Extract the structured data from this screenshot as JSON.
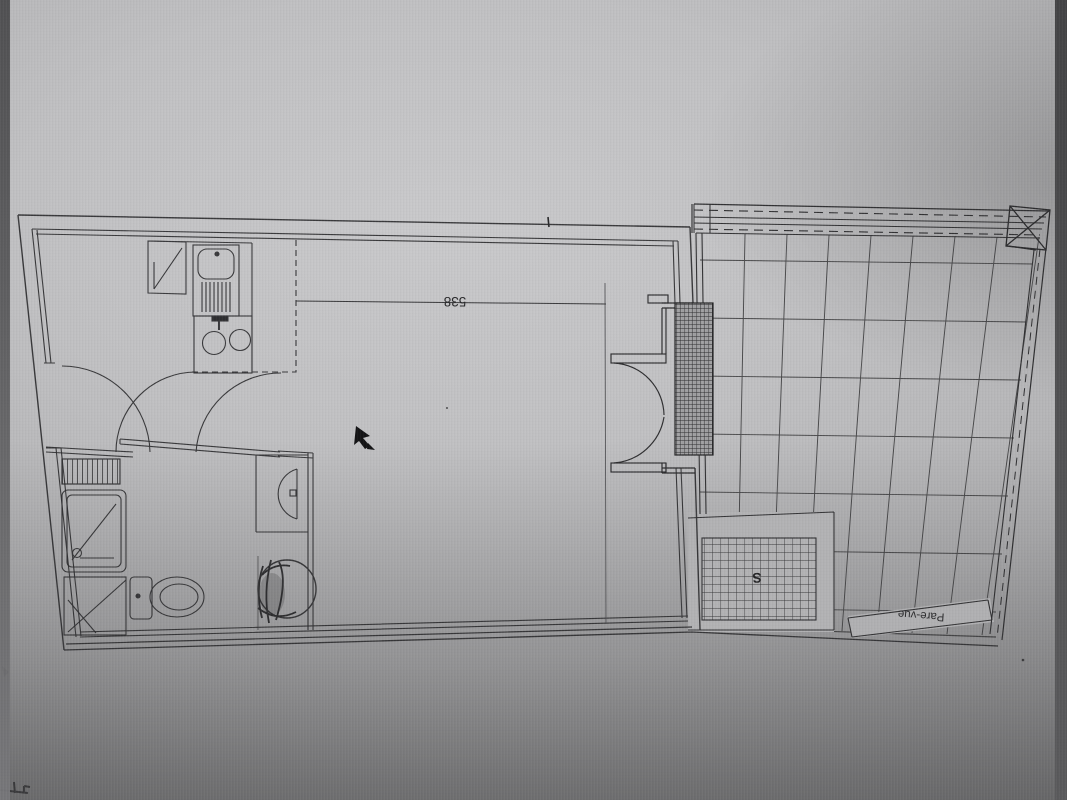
{
  "plan": {
    "dimension_label": "538",
    "privacy_screen_label": "Pare-vue",
    "floor_grate_mark": "S",
    "fixtures": [
      "fridge-cabinet",
      "kitchen-sink",
      "sink-drainer",
      "hob-two-burners",
      "towel-radiator",
      "shower-tray",
      "bathroom-cabinet",
      "toilet",
      "washbasin",
      "washing-machine",
      "entry-door-swing",
      "bathroom-door-swing",
      "french-doors-to-terrace",
      "glazing-hatch",
      "terrace-tile-grid",
      "floor-grate",
      "privacy-screen-panel",
      "guardrail-dashed",
      "corner-column-x"
    ]
  },
  "colors": {
    "line": "#2e2e30",
    "line_light": "#47474a",
    "background_light": "#c9c9cb",
    "background_mid": "#b0b0b2",
    "background_dark": "#868688",
    "edge_strip_left": "#59595b",
    "edge_strip_right": "#4a4a4c",
    "paper_mask": "#b2b2b4",
    "ink_dark": "#1c1c1e"
  }
}
